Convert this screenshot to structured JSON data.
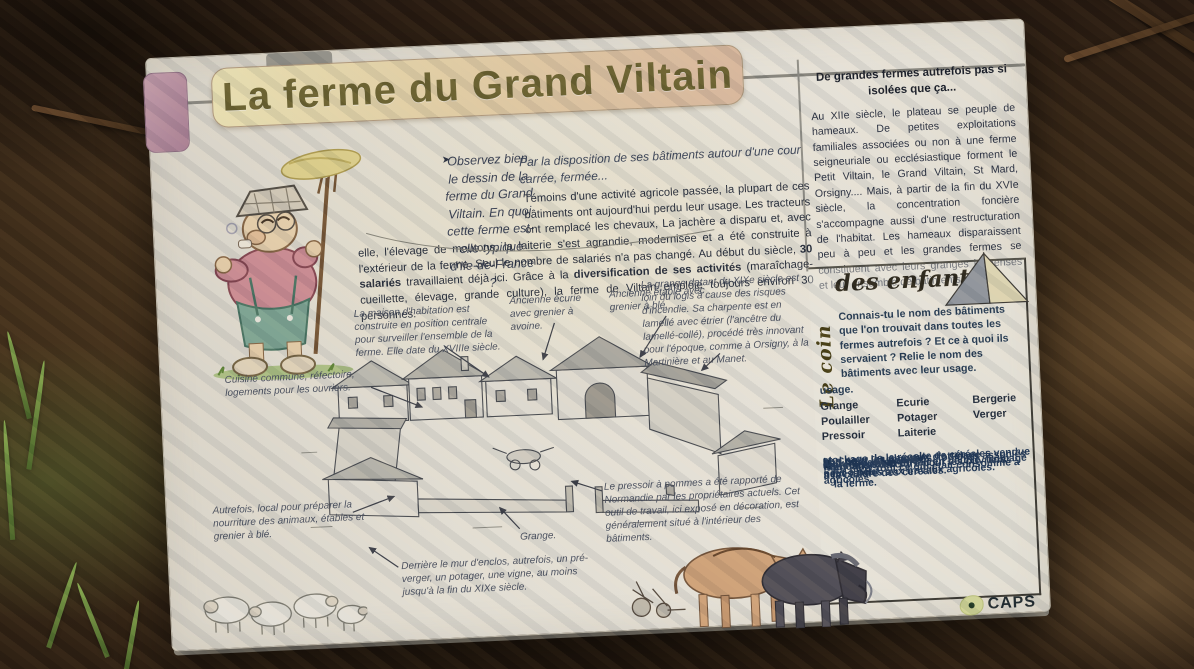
{
  "panel": {
    "title": "La ferme du Grand Viltain",
    "observe_pointer_icon": "➤",
    "observe_question": "Observez bien le dessin de la ferme du Grand Viltain. En quoi cette ferme est-elle typique d'Ile-de-France ?",
    "lead": "Par la disposition de ses bâtiments autour d'une cour carrée, fermée...",
    "main": {
      "p1": "Témoins d'une activité agricole passée, la plupart de ces bâtiments ont aujourd'hui perdu leur usage. Les tracteurs ont remplacé les chevaux, La jachère a disparu et, avec elle, l'élevage de moutons, la laiterie s'est agrandie, modernisée et a été construite à l'extérieur de la ferme. Seul le nombre de salariés n'a pas changé. Au début du siècle, ",
      "b1": "30 salariés",
      "p2": " travaillaient déjà ici. Grâce à la ",
      "b2": "diversification de ses activités",
      "p3": " (maraîchage-cueillette, élevage, grande culture), la ferme de Viltain emploie toujours environ 30 personnes."
    }
  },
  "sidebar": {
    "heading": "De grandes fermes autrefois pas si isolées que ça...",
    "body": "Au XIIe siècle, le plateau se peuple de hameaux. De petites exploitations familiales associées ou non à une ferme seigneuriale ou ecclésiastique forment le Petit Viltain, le Grand Viltain, St Mard, Orsigny.... Mais, à partir de la fin du XVIe siècle, la concentration foncière s'accompagne aussi d'une restructuration de l'habitat. Les hameaux disparaissent peu à peu et les grandes fermes se constituent avec leurs granges immenses et leur ensemble de bâtiments."
  },
  "captions": {
    "grange_note": "La grange datant du XIXe siècle est loin du logis à cause des risques d'incendie. Sa charpente est en lamellé avec étrier (l'ancêtre du lamellé-collé), procédé très innovant pour l'époque, comme à Orsigny, à la Martinière et au Manet.",
    "maison": "La maison d'habitation est construite en position centrale pour surveiller l'ensemble de la ferme. Elle date du XVIIIe siècle.",
    "ecurie": "Ancienne écurie avec grenier à avoine.",
    "etable": "Ancienne étable avec grenier à blé.",
    "cuisine": "Cuisine commune, réfectoire, logements pour les ouvriers.",
    "autrefois": "Autrefois, local pour préparer la nourriture des animaux, étables et grenier à blé.",
    "pressoir": "Le pressoir à pommes a été rapporté de Normandie par les propriétaires actuels. Cet outil de travail, ici exposé en décoration, est généralement situé à l'intérieur des bâtiments.",
    "grange_label": "Grange.",
    "enclos": "Derrière le mur d'enclos, autrefois, un pré-verger, un potager, une vigne, au moins jusqu'à la fin du XIXe siècle."
  },
  "kids_box": {
    "vertical_label": "Le coin",
    "heading": "des enfants",
    "intro": "Connais-tu le nom des bâtiments que l'on trouvait dans toutes les fermes autrefois ? Et ce à quoi ils servaient ? Relie le nom des bâtiments avec leur usage.",
    "usage_word": "usage.",
    "bullet_icon": "↪",
    "words": [
      "Grange",
      "Ecurie",
      "Bergerie",
      "Poulailler",
      "Potager",
      "Verger",
      "Pressoir",
      "Laiterie"
    ],
    "bullets": [
      "stockage de la récolte de céréales vendue petit à petit.",
      "abri pour les chevaux d'attelage nécessaires aux travaux agricoles.",
      "abri pour les moutons, toujours associés à la culture des céréales.",
      "abri pour les poules",
      "culture des légumes",
      "arbres fruitiers",
      "transformation du lait en beurre, fromage",
      "fabrication du cidre pour les ouvriers agricoles."
    ],
    "footer": "En bleu, tout ce qui était consommé à la ferme."
  },
  "logo": {
    "text": "CAPS"
  },
  "colors": {
    "panel_bg": "#f2f0e7",
    "banner_left": "#f7f0c1",
    "banner_right": "#e6c5ab",
    "title_text": "#6f6835",
    "body_text": "#273041",
    "kids_text": "#1f3a5e",
    "logo_blob": "#dde4a4",
    "background_soil": "#3c2b19"
  }
}
